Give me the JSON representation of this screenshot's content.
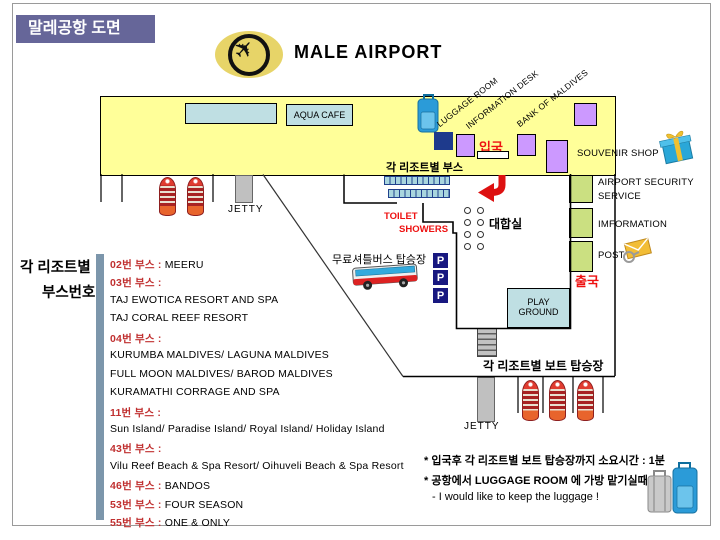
{
  "page": {
    "title_box": "말레공항 도면",
    "heading": "MALE AIRPORT"
  },
  "icons": {
    "airplane": "✈",
    "parking": "P",
    "gift": "gift-box",
    "mail": "envelope-with-magnifier",
    "bus": "shuttle-bus",
    "boat": "resort-boat",
    "luggage": "suitcase"
  },
  "terminal": {
    "aqua_cafe": "AQUA CAFE",
    "arrival": "입국",
    "booths_label": "각 리조트별 부스",
    "diagonal_labels": [
      "LUGGAGE ROOM",
      "INFORMATION DESK",
      "BANK OF MALDIVES"
    ]
  },
  "right": {
    "souvenir": "SOUVENIR SHOP",
    "security1": "AIRPORT SECURITY",
    "security2": "SERVICE",
    "information": "IMFORMATION",
    "post": "POST",
    "departure": "출국"
  },
  "hall": {
    "waiting": "대합실",
    "toilet": "TOILET",
    "showers": "SHOWERS",
    "play1": "PLAY",
    "play2": "GROUND",
    "shuttle": "무료셔틀버스 탑승장",
    "boat_label": "각 리조트별 보트 탑승장",
    "jetty_top": "JETTY",
    "jetty_bottom": "JETTY"
  },
  "panel": {
    "header1": "각 리조트별",
    "header2": "부스번호",
    "rows": [
      {
        "red": "02번 부스 :",
        "black": " MEERU"
      },
      {
        "red": "03번 부스 :",
        "black": ""
      },
      {
        "red": "",
        "black": "TAJ EWOTICA RESORT AND SPA"
      },
      {
        "red": "",
        "black": "TAJ CORAL REEF RESORT"
      },
      {
        "red": "04번 부스 :",
        "black": ""
      },
      {
        "red": "",
        "black": "KURUMBA MALDIVES/ LAGUNA MALDIVES"
      },
      {
        "red": "",
        "black": "FULL MOON MALDIVES/ BAROD MALDIVES"
      },
      {
        "red": "",
        "black": "KURAMATHI CORRAGE AND SPA"
      },
      {
        "red": "11번 부스 :",
        "black": ""
      },
      {
        "red": "",
        "black": "Sun Island/ Paradise Island/ Royal Island/ Holiday Island"
      },
      {
        "red": "43번 부스 :",
        "black": ""
      },
      {
        "red": "",
        "black": "Vilu Reef Beach & Spa Resort/ Oihuveli Beach & Spa Resort"
      },
      {
        "red": "46번 부스 :",
        "black": " BANDOS"
      },
      {
        "red": "53번 부스 :",
        "black": " FOUR SEASON"
      },
      {
        "red": "55번 부스 :",
        "black": " ONE & ONLY"
      }
    ]
  },
  "notes": {
    "line1": "* 입국후 각 리조트별 보트 탑승장까지 소요시간 : 1분",
    "line2": "* 공항에서 LUGGAGE ROOM 에 가방 맡기실때",
    "line3": "- I would like to keep the luggage !"
  },
  "colors": {
    "terminal_yellow": "#FFFF99",
    "purple": "#CC99FF",
    "navy": "#1E3A8C",
    "light_blue": "#BFDFE3",
    "green": "#CBE081",
    "red": "#EE1111",
    "list_red": "#C03030",
    "title_bg": "#666699",
    "divider": "#7C96AB"
  }
}
